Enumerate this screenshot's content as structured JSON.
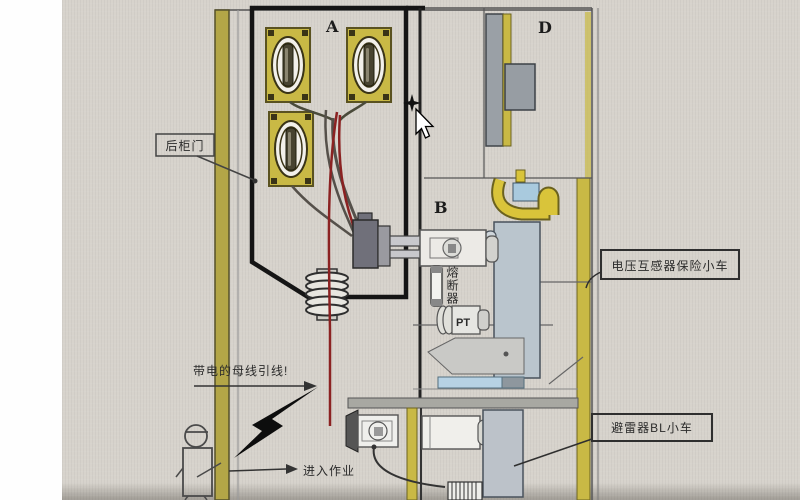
{
  "compartments": {
    "a": "A",
    "b": "B",
    "d": "D"
  },
  "labels": {
    "rear_door": "后柜门",
    "pt_fuse_trolley": "电压互感器保险小车",
    "arrester_trolley": "避雷器BL小车",
    "live_busbar_lead": "带电的母线引线!",
    "enter_work": "进入作业",
    "fuse": "熔断器",
    "pt": "PT"
  },
  "colors": {
    "photo_background": "#d7d3cc",
    "cabinet_yellow": "#c9b945",
    "wall_olive": "#b3a647",
    "busbar_yellow": "#d9c43a",
    "panel_blue_gray": "#bac5cd",
    "divider_blue": "#b7d2e4",
    "cable_red": "#8b2222",
    "outline_dark": "#151515",
    "metal_gray": "#9aa0a6"
  }
}
